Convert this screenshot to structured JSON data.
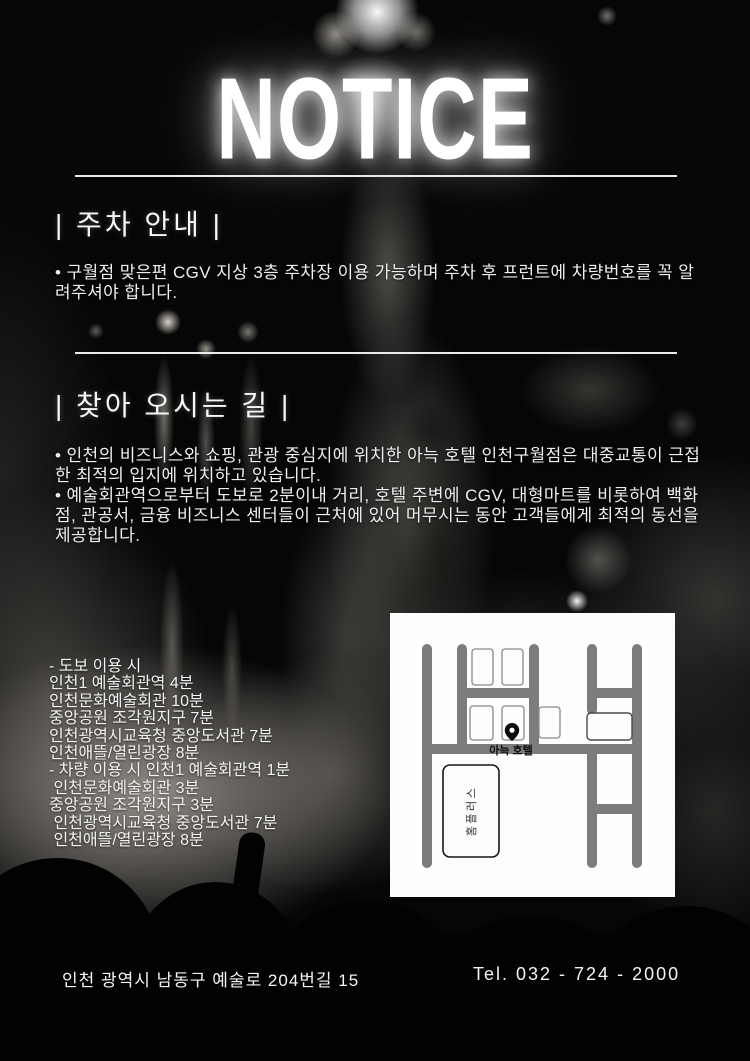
{
  "title": "NOTICE",
  "colors": {
    "background": "#060606",
    "text": "#f2f2f2",
    "divider": "#eaeaea",
    "map_background": "#fdfdfd",
    "map_road": "#7c7c7c",
    "pin": "#0a0a0a"
  },
  "sections": {
    "parking": {
      "heading": "| 주차 안내 |",
      "body": "• 구월점 맞은편 CGV 지상 3층 주차장 이용 가능하며 주차 후 프런트에 차량번호를 꼭 알려주셔야 합니다."
    },
    "way": {
      "heading": "| 찾아 오시는 길 |",
      "bullets": [
        "• 인천의 비즈니스와 쇼핑, 관광 중심지에 위치한 아늑 호텔 인천구월점은 대중교통이 근접한 최적의 입지에 위치하고 있습니다.",
        "• 예술회관역으로부터 도보로 2분이내 거리, 호텔 주변에 CGV, 대형마트를 비롯하여 백화점, 관공서, 금융 비즈니스 센터들이 근처에 있어 머무시는 동안 고객들에게 최적의 동선을 제공합니다."
      ],
      "routes": [
        "- 도보 이용 시",
        "인천1 예술회관역 4분",
        "인천문화예술회관 10분",
        "중앙공원 조각원지구 7분",
        "인천광역시교육청 중앙도서관 7분",
        "인천애뜰/열린광장 8분",
        "- 차량 이용 시 인천1 예술회관역 1분",
        " 인천문화예술회관 3분",
        "중앙공원 조각원지구 3분",
        " 인천광역시교육청 중앙도서관 7분",
        " 인천애뜰/열린광장 8분"
      ]
    }
  },
  "map": {
    "hotel_label": "아늑 호텔",
    "store_label": "홈플러스"
  },
  "footer": {
    "address": "인천 광역시 남동구 예술로 204번길 15",
    "tel": "Tel. 032 - 724 - 2000"
  }
}
